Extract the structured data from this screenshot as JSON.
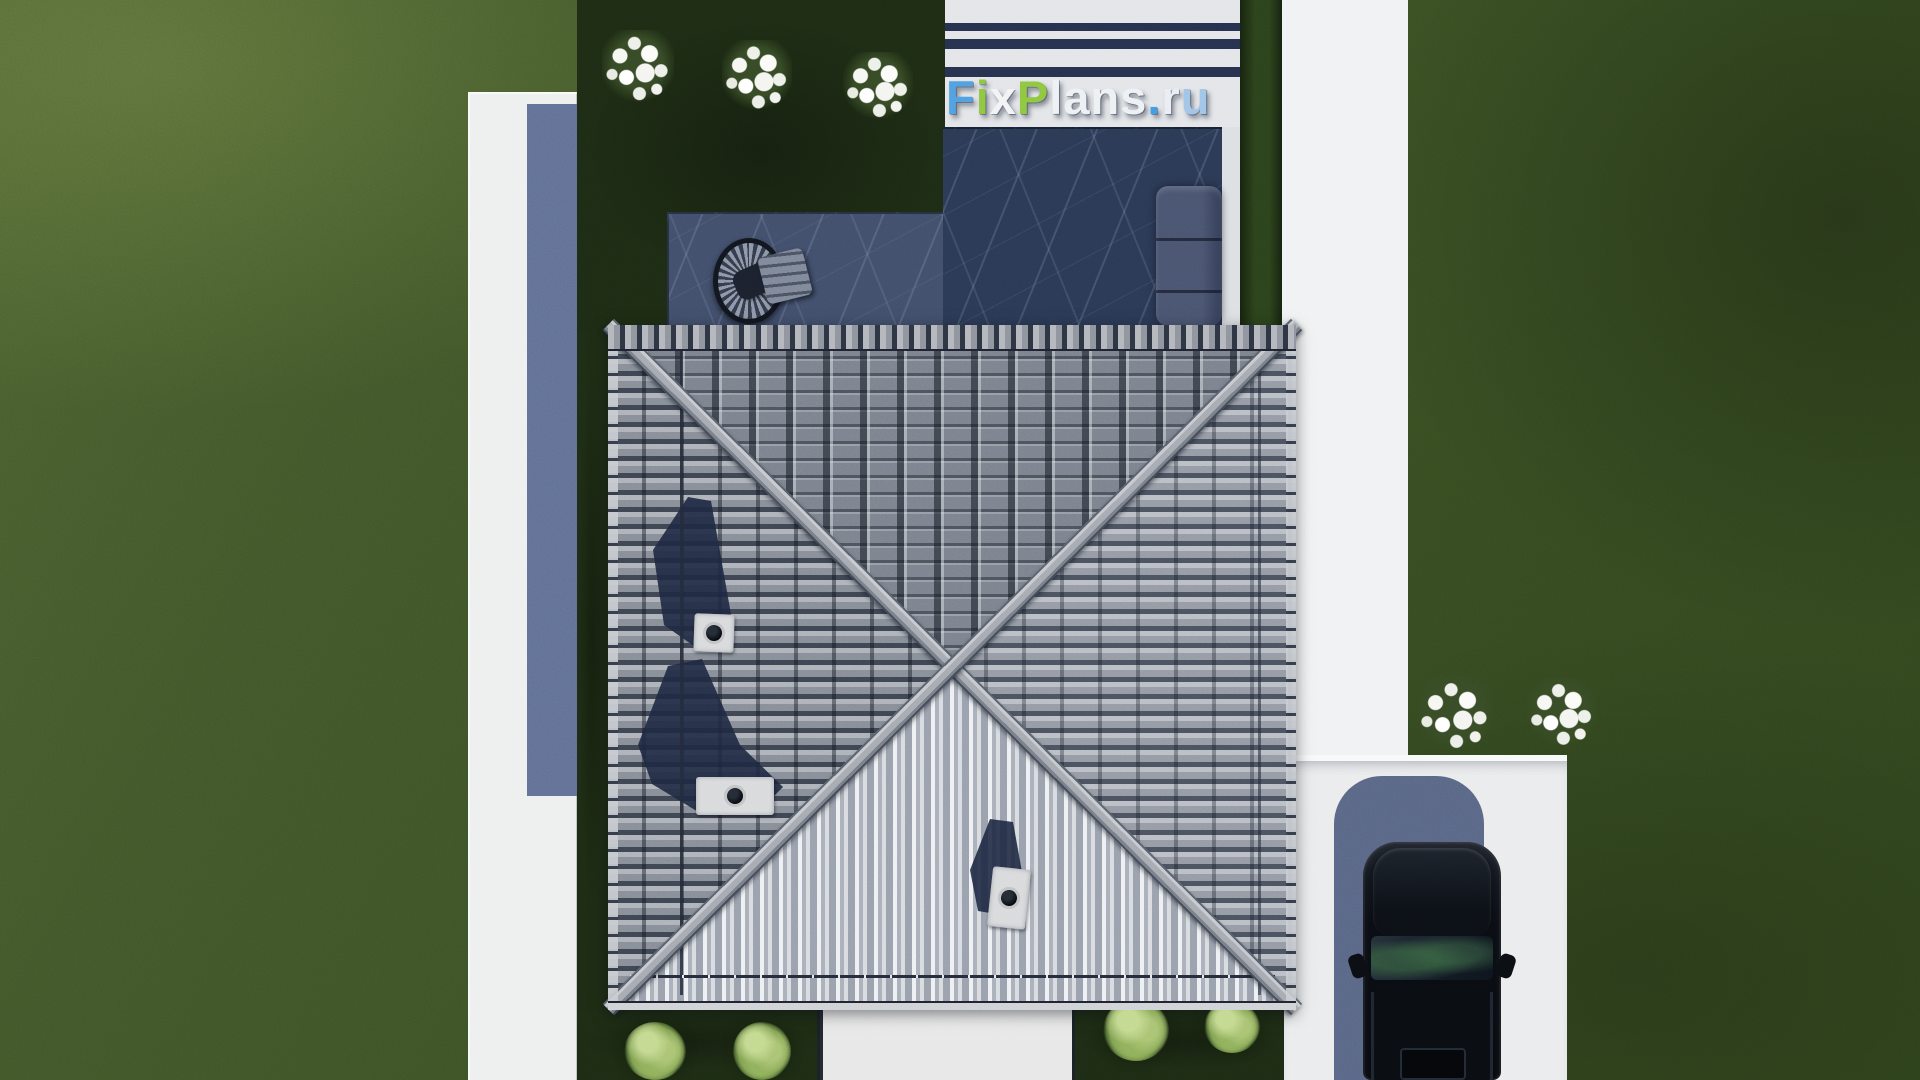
{
  "watermark": {
    "text": "FixPlans.ru",
    "letters": [
      {
        "ch": "F",
        "color": "#4f9fe0"
      },
      {
        "ch": "i",
        "color": "#8dc63f"
      },
      {
        "ch": "x",
        "color": "#f2f3f5"
      },
      {
        "ch": "P",
        "color": "#8dc63f"
      },
      {
        "ch": "l",
        "color": "#eef1f4"
      },
      {
        "ch": "a",
        "color": "#eef1f4"
      },
      {
        "ch": "n",
        "color": "#eef1f4"
      },
      {
        "ch": "s",
        "color": "#eef1f4"
      },
      {
        "ch": ".",
        "color": "#3f9be0"
      },
      {
        "ch": "r",
        "color": "#e9eef4"
      },
      {
        "ch": "u",
        "color": "#9fc4e8"
      }
    ]
  },
  "scene": {
    "type": "aerial-render-of-house-plan",
    "objects": [
      "square hip roof with gray tiles and X ridges",
      "single-flue chimney",
      "triple-flue chimney",
      "double-flue chimney",
      "chimney shadows on roof",
      "dark pool water",
      "stone terrace",
      "hanging egg chair",
      "outdoor sofa",
      "striped pergola pavement",
      "white garden paths",
      "driveway",
      "black SUV parked on driveway",
      "car shadow",
      "three white flower bushes top",
      "two white flower bushes right",
      "four light green shrubs bottom",
      "dark inner-yard lawn",
      "outer lawn",
      "house shadow band on left path"
    ],
    "colors": {
      "grass_outer": "#3c5226",
      "grass_inner": "#1d2b14",
      "pavement": "#eef0ef",
      "shadow_blue": "#5b6a91",
      "pool_water": "#2b3954",
      "terrace_stone": "#414e6a",
      "roof_light_face": "#c2c6cd",
      "roof_mid_face": "#80868f",
      "roof_dark_gap": "#39404e",
      "ridge_cap": "#a6aab1",
      "stripe_navy": "#26314e",
      "car_body": "#0a0d13",
      "accent_green": "#8dc63f",
      "accent_blue": "#4f9fe0"
    }
  }
}
